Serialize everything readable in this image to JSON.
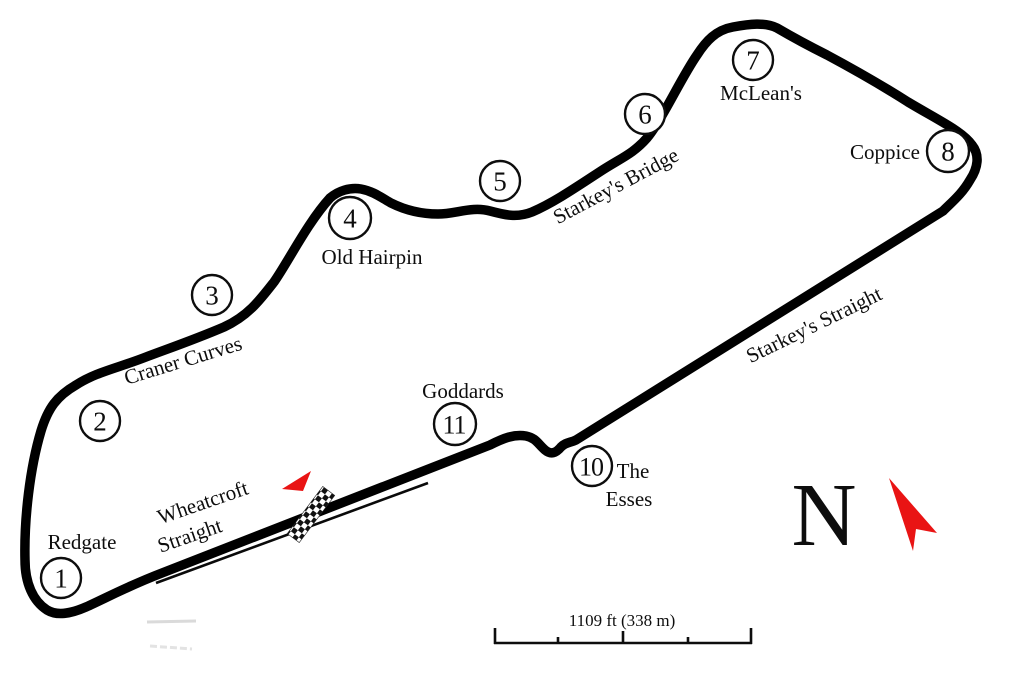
{
  "map": {
    "background": "#ffffff",
    "track_color": "#000000",
    "accent_red": "#e91414"
  },
  "corners": [
    {
      "number": "1"
    },
    {
      "number": "2"
    },
    {
      "number": "3"
    },
    {
      "number": "4"
    },
    {
      "number": "5"
    },
    {
      "number": "6"
    },
    {
      "number": "7"
    },
    {
      "number": "8"
    },
    {
      "number": "10"
    },
    {
      "number": "11"
    }
  ],
  "labels": {
    "redgate": "Redgate",
    "craner_curves": "Craner Curves",
    "old_hairpin": "Old Hairpin",
    "starkeys_bridge": "Starkey's Bridge",
    "mcleans": "McLean's",
    "coppice": "Coppice",
    "starkeys_straight": "Starkey's Straight",
    "goddards": "Goddards",
    "the_esses_line1": "The",
    "the_esses_line2": "Esses",
    "wheatcroft_line1": "Wheatcroft",
    "wheatcroft_line2": "Straight"
  },
  "compass": {
    "north": "N"
  },
  "scale": {
    "label": "1109 ft (338 m)"
  }
}
